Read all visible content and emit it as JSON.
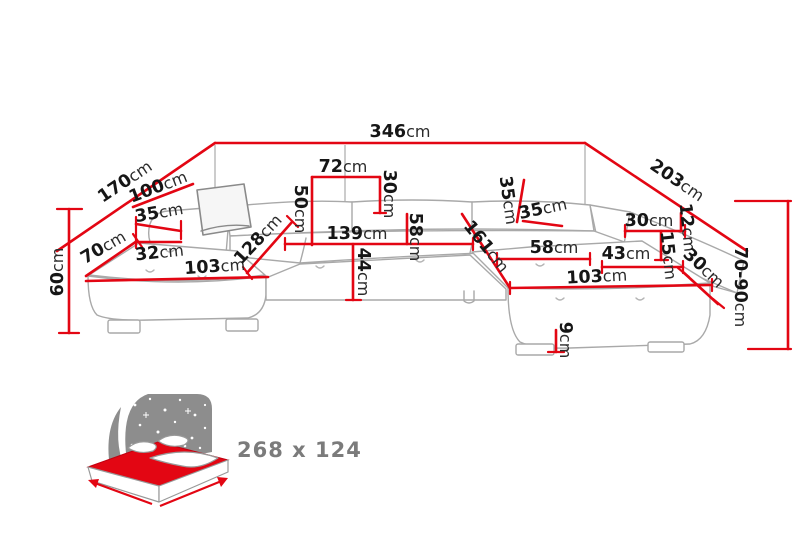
{
  "diagram_title": "corner-sofa-dimension-diagram",
  "colors": {
    "dimension_red": "#e30613",
    "label_black": "#161616",
    "sofa_line_gray": "#a9a9a9",
    "icon_gray": "#8d8d8d",
    "caption_gray": "#7b7b7b",
    "background": "#ffffff"
  },
  "sleeping_area": {
    "label": "268 x 124"
  },
  "gray_leader_lines": [
    [
      215,
      145,
      215,
      207
    ],
    [
      585,
      145,
      585,
      204
    ],
    [
      345,
      145,
      345,
      202
    ]
  ],
  "red_lines": [
    {
      "id": "back-width-346",
      "x1": 215,
      "y1": 143,
      "x2": 585,
      "y2": 143
    },
    {
      "id": "left-side-170",
      "x1": 57,
      "y1": 251,
      "x2": 215,
      "y2": 143
    },
    {
      "id": "right-side-203",
      "x1": 585,
      "y1": 143,
      "x2": 747,
      "y2": 251
    },
    {
      "id": "left-back-100",
      "x1": 133,
      "y1": 207,
      "x2": 193,
      "y2": 184
    },
    {
      "id": "left-arm-35",
      "x1": 136,
      "y1": 224,
      "x2": 181,
      "y2": 231
    },
    {
      "id": "left-arm-32",
      "x1": 136,
      "y1": 242,
      "x2": 181,
      "y2": 242
    },
    {
      "id": "left-chaise-width-70",
      "x1": 86,
      "y1": 276,
      "x2": 137,
      "y2": 241
    },
    {
      "id": "left-chaise-length-103",
      "x1": 86,
      "y1": 281,
      "x2": 268,
      "y2": 277
    },
    {
      "id": "left-diagonal-128",
      "x1": 247,
      "y1": 273,
      "x2": 292,
      "y2": 222
    },
    {
      "id": "back-segment-72",
      "x1": 312,
      "y1": 177,
      "x2": 380,
      "y2": 177
    },
    {
      "id": "back-height-50",
      "x1": 312,
      "y1": 177,
      "x2": 312,
      "y2": 245
    },
    {
      "id": "back-depth-30",
      "x1": 380,
      "y1": 177,
      "x2": 380,
      "y2": 213
    },
    {
      "id": "seat-width-139",
      "x1": 285,
      "y1": 244,
      "x2": 473,
      "y2": 244
    },
    {
      "id": "seat-depth-44",
      "x1": 353,
      "y1": 244,
      "x2": 353,
      "y2": 300
    },
    {
      "id": "seat-58",
      "x1": 407,
      "y1": 214,
      "x2": 407,
      "y2": 244
    },
    {
      "id": "right-back-35-vertical",
      "x1": 524,
      "y1": 180,
      "x2": 517,
      "y2": 222
    },
    {
      "id": "right-back-35",
      "x1": 523,
      "y1": 221,
      "x2": 562,
      "y2": 226
    },
    {
      "id": "right-diagonal-161",
      "x1": 462,
      "y1": 214,
      "x2": 510,
      "y2": 288
    },
    {
      "id": "right-seat-58",
      "x1": 497,
      "y1": 259,
      "x2": 590,
      "y2": 259
    },
    {
      "id": "right-seat-43",
      "x1": 602,
      "y1": 267,
      "x2": 683,
      "y2": 267
    },
    {
      "id": "right-chaise-length-103",
      "x1": 510,
      "y1": 288,
      "x2": 712,
      "y2": 285
    },
    {
      "id": "right-arm-30",
      "x1": 625,
      "y1": 231,
      "x2": 685,
      "y2": 231
    },
    {
      "id": "right-arm-12",
      "x1": 681,
      "y1": 213,
      "x2": 681,
      "y2": 231
    },
    {
      "id": "right-arm-15",
      "x1": 661,
      "y1": 231,
      "x2": 661,
      "y2": 260
    },
    {
      "id": "right-corner-30",
      "x1": 683,
      "y1": 272,
      "x2": 718,
      "y2": 304
    },
    {
      "id": "left-height-60",
      "x1": 69,
      "y1": 209,
      "x2": 69,
      "y2": 333
    },
    {
      "id": "height-70-90",
      "x1": 788,
      "y1": 201,
      "x2": 788,
      "y2": 349
    },
    {
      "id": "clearance-9",
      "x1": 556,
      "y1": 330,
      "x2": 556,
      "y2": 352
    }
  ],
  "red_ticks": [
    [
      57,
      209,
      82,
      209
    ],
    [
      59,
      333,
      79,
      333
    ],
    [
      735,
      201,
      791,
      201
    ],
    [
      748,
      349,
      791,
      349
    ],
    [
      346,
      300,
      361,
      300
    ],
    [
      548,
      352,
      564,
      352
    ],
    [
      133,
      234,
      142,
      247
    ],
    [
      181,
      221,
      181,
      239
    ],
    [
      136,
      217,
      136,
      248
    ],
    [
      287,
      216,
      298,
      227
    ],
    [
      243,
      267,
      252,
      279
    ],
    [
      285,
      238,
      285,
      250
    ],
    [
      473,
      238,
      473,
      250
    ],
    [
      497,
      253,
      497,
      265
    ],
    [
      590,
      253,
      590,
      265
    ],
    [
      602,
      261,
      602,
      273
    ],
    [
      683,
      261,
      683,
      273
    ],
    [
      510,
      282,
      510,
      294
    ],
    [
      712,
      279,
      712,
      291
    ],
    [
      625,
      225,
      625,
      237
    ],
    [
      685,
      225,
      685,
      237
    ],
    [
      678,
      268,
      689,
      277
    ],
    [
      713,
      299,
      724,
      308
    ],
    [
      374,
      213,
      386,
      213
    ],
    [
      655,
      260,
      668,
      260
    ]
  ],
  "labels": [
    {
      "value": "346",
      "unit": "cm",
      "x": 400,
      "y": 137,
      "rot": 0
    },
    {
      "value": "170",
      "unit": "cm",
      "x": 128,
      "y": 186,
      "rot": -34
    },
    {
      "value": "203",
      "unit": "cm",
      "x": 674,
      "y": 185,
      "rot": 34
    },
    {
      "value": "100",
      "unit": "cm",
      "x": 160,
      "y": 192,
      "rot": -21
    },
    {
      "value": "35",
      "unit": "cm",
      "x": 160,
      "y": 218,
      "rot": -10
    },
    {
      "value": "32",
      "unit": "cm",
      "x": 160,
      "y": 258,
      "rot": -6
    },
    {
      "value": "70",
      "unit": "cm",
      "x": 106,
      "y": 252,
      "rot": -30
    },
    {
      "value": "103",
      "unit": "cm",
      "x": 215,
      "y": 272,
      "rot": -4
    },
    {
      "value": "128",
      "unit": "cm",
      "x": 262,
      "y": 243,
      "rot": -47
    },
    {
      "value": "72",
      "unit": "cm",
      "x": 343,
      "y": 172,
      "rot": 0
    },
    {
      "value": "30",
      "unit": "cm",
      "x": 384,
      "y": 194,
      "rot": 90
    },
    {
      "value": "50",
      "unit": "cm",
      "x": 295,
      "y": 209,
      "rot": 90
    },
    {
      "value": "139",
      "unit": "cm",
      "x": 357,
      "y": 239,
      "rot": 0
    },
    {
      "value": "44",
      "unit": "cm",
      "x": 358,
      "y": 272,
      "rot": 90
    },
    {
      "value": "58",
      "unit": "cm",
      "x": 410,
      "y": 237,
      "rot": 90
    },
    {
      "value": "35",
      "unit": "cm",
      "x": 503,
      "y": 201,
      "rot": 82
    },
    {
      "value": "35",
      "unit": "cm",
      "x": 544,
      "y": 214,
      "rot": -12
    },
    {
      "value": "161",
      "unit": "cm",
      "x": 482,
      "y": 250,
      "rot": 51
    },
    {
      "value": "58",
      "unit": "cm",
      "x": 554,
      "y": 253,
      "rot": 0
    },
    {
      "value": "43",
      "unit": "cm",
      "x": 626,
      "y": 259,
      "rot": 0
    },
    {
      "value": "103",
      "unit": "cm",
      "x": 597,
      "y": 282,
      "rot": -3
    },
    {
      "value": "30",
      "unit": "cm",
      "x": 649,
      "y": 226,
      "rot": 0
    },
    {
      "value": "12",
      "unit": "cm",
      "x": 682,
      "y": 228,
      "rot": 84
    },
    {
      "value": "15",
      "unit": "cm",
      "x": 663,
      "y": 256,
      "rot": 84
    },
    {
      "value": "30",
      "unit": "cm",
      "x": 700,
      "y": 272,
      "rot": 43
    },
    {
      "value": "70-90",
      "unit": "cm",
      "x": 735,
      "y": 287,
      "rot": 90
    },
    {
      "value": "60",
      "unit": "cm",
      "x": 63,
      "y": 272,
      "rot": -90
    },
    {
      "value": "9",
      "unit": "cm",
      "x": 560,
      "y": 340,
      "rot": 90
    }
  ]
}
